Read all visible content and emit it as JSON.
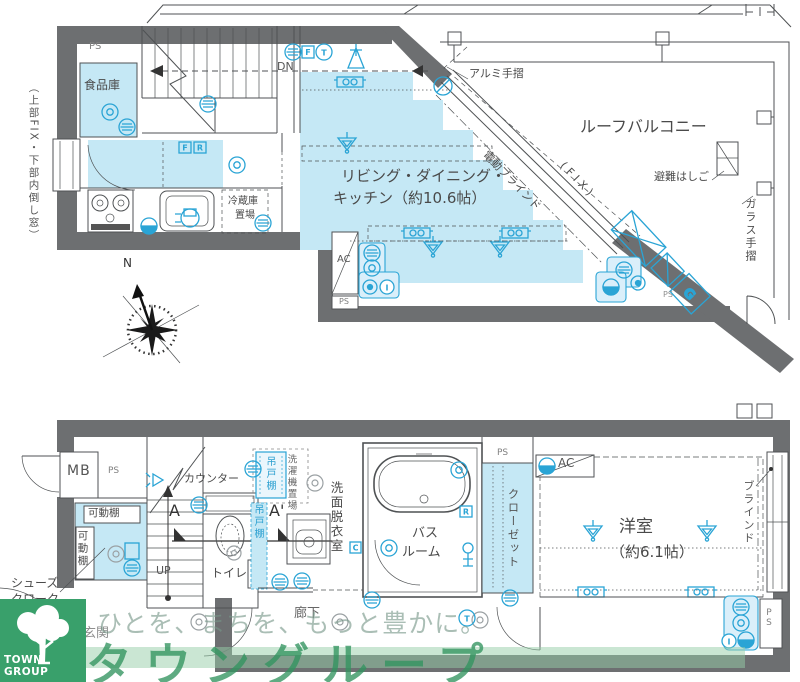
{
  "colors": {
    "wall": "#6d6f71",
    "room_fill": "#c5e8f5",
    "icon_blue": "#2aa4d5",
    "brand_green": "#39a06b"
  },
  "upper": {
    "ps_top": "PS",
    "pantry": "食品庫",
    "window_note": "（上部FIX・下部内倒し窓）",
    "dn": "DN",
    "ldk1": "リビング・ダイニング・",
    "ldk2": "キッチン（約10.6帖）",
    "fridge1": "冷蔵庫",
    "fridge2": "置場",
    "alumi": "アルミ手摺",
    "balcony": "ルーフバルコニー",
    "ladder": "避難はしご",
    "glass": "ガラス手摺",
    "blind": "電動ブラインド",
    "fix": "(FIX)",
    "ac": "AC",
    "ps_ac": "PS",
    "ps_diag": "PS",
    "north": "N"
  },
  "lower": {
    "mb": "MB",
    "ps_left": "PS",
    "movable1": "可動棚",
    "movable2": "可動棚",
    "shoes1": "シューズ",
    "shoes2": "クローク",
    "genkan": "玄関",
    "up": "UP",
    "a": "A",
    "a_prime": "A'",
    "counter": "カウンター",
    "toilet": "トイレ",
    "hang1": "吊戸棚",
    "hang2": "吊戸棚",
    "washer": "洗濯機置場",
    "washroom": "洗面脱衣室",
    "bath1": "バス",
    "bath2": "ルーム",
    "ps_top": "PS",
    "closet": "クローゼット",
    "room": "洋室",
    "room_size": "（約6.1帖）",
    "blind": "ブラインド",
    "ac": "AC",
    "hall": "廊下",
    "ps_br": "PS"
  },
  "icons": {
    "f": "F",
    "r": "R",
    "t": "T",
    "g": "G",
    "c": "C",
    "i": "I"
  },
  "watermark": {
    "tagline": "ひとを、まちを、もっと豊かに。",
    "brand": "タウングループ",
    "logo": "TOWN GROUP"
  }
}
